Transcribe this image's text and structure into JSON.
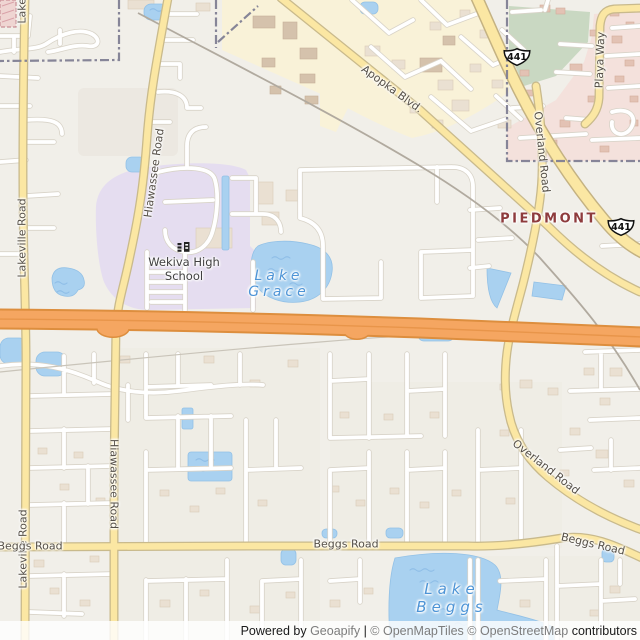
{
  "map": {
    "road_labels": [
      {
        "text": "Hiawassee Road"
      },
      {
        "text": "Hiawassee Road"
      },
      {
        "text": "Lakeville Road"
      },
      {
        "text": "Lakeville Road"
      },
      {
        "text": "Lakeville Road"
      },
      {
        "text": "Apopka Blvd."
      },
      {
        "text": "Overland Road"
      },
      {
        "text": "Overland Road"
      },
      {
        "text": "Playa Way"
      },
      {
        "text": "Beggs Road"
      },
      {
        "text": "Beggs Road"
      },
      {
        "text": "Beggs Road"
      }
    ],
    "place_labels": [
      {
        "text": "PIEDMONT"
      }
    ],
    "poi_labels": [
      {
        "line1": "Wekiva High",
        "line2": "School",
        "icon": "school-icon"
      }
    ],
    "water_labels": [
      {
        "line1": "Lake",
        "line2": "Grace"
      },
      {
        "line1": "Lake",
        "line2": "Beggs"
      }
    ],
    "shields": [
      {
        "label": "441"
      },
      {
        "label": "441"
      }
    ],
    "attribution": {
      "powered_by": "Powered by ",
      "brand": "Geoapify",
      "separator": " | ",
      "openmaptiles": "© OpenMapTiles ",
      "openstreetmap": "© OpenStreetMap ",
      "contributors": "contributors"
    },
    "colors": {
      "land": "#F1EFE9",
      "water": "#A9D1F0",
      "water_label": "#4D94D6",
      "motorway": "#F5A661",
      "road_yellow": "#FBE7A3",
      "residential_pink": "#F4E1DC",
      "school_purple": "#E5DDF0",
      "commercial_yellow": "#F9F2D8",
      "green_area": "#C9D8C2",
      "boundary": "#807E93",
      "place_label": "#8E3B3D"
    }
  }
}
